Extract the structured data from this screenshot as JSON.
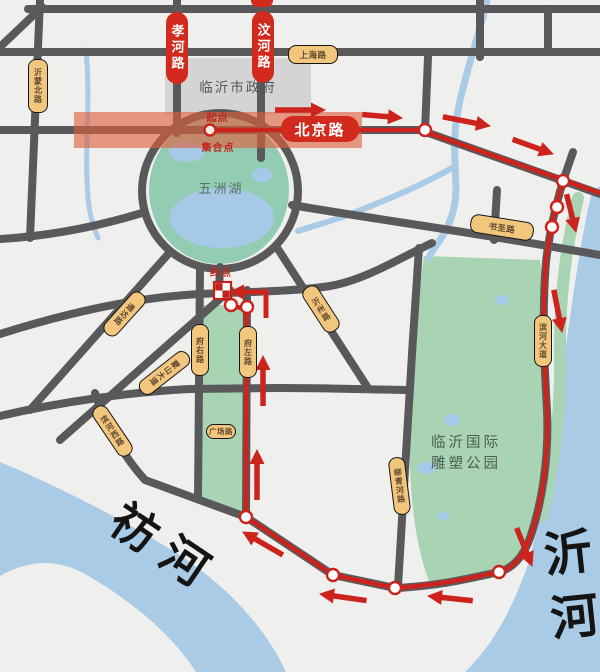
{
  "map_title": "临沂马拉松路线图",
  "labels": {
    "government": "临沂市政府",
    "lake": "五洲湖",
    "park_line1": "临沂国际",
    "park_line2": "雕塑公园",
    "river_left": "祊河",
    "river_right": "沂河"
  },
  "route_markers": {
    "start": "起点",
    "assembly": "集合点",
    "finish": "终点"
  },
  "red_road_labels": {
    "xiaohe": "孝河路",
    "wenhe": "汶河路",
    "beijing": "北京路"
  },
  "road_labels": {
    "yimengbei": "沂蒙北路",
    "shanghai": "上海路",
    "shusheng": "书圣路",
    "binhe_dadao": "滨河大道",
    "fuyou": "府右路",
    "fuzuo": "府左路",
    "yizhou": "沂州路",
    "tongda": "通达路",
    "mengshan": "蒙山大道",
    "binhe_xi": "滨河西路",
    "guangchang": "广场路",
    "liuqinghe": "柳青河路"
  },
  "colors": {
    "route_red": "#cd231d",
    "road_gray": "#59595b",
    "river_blue": "#a9cbe6",
    "park_green": "#a8d4b4",
    "lake_green": "#92ccb2",
    "pill_tan": "#f3c67d",
    "pill_red": "#d22b1e",
    "building_gray": "#d4d4d4",
    "start_band": "rgba(222,96,60,0.62)"
  }
}
